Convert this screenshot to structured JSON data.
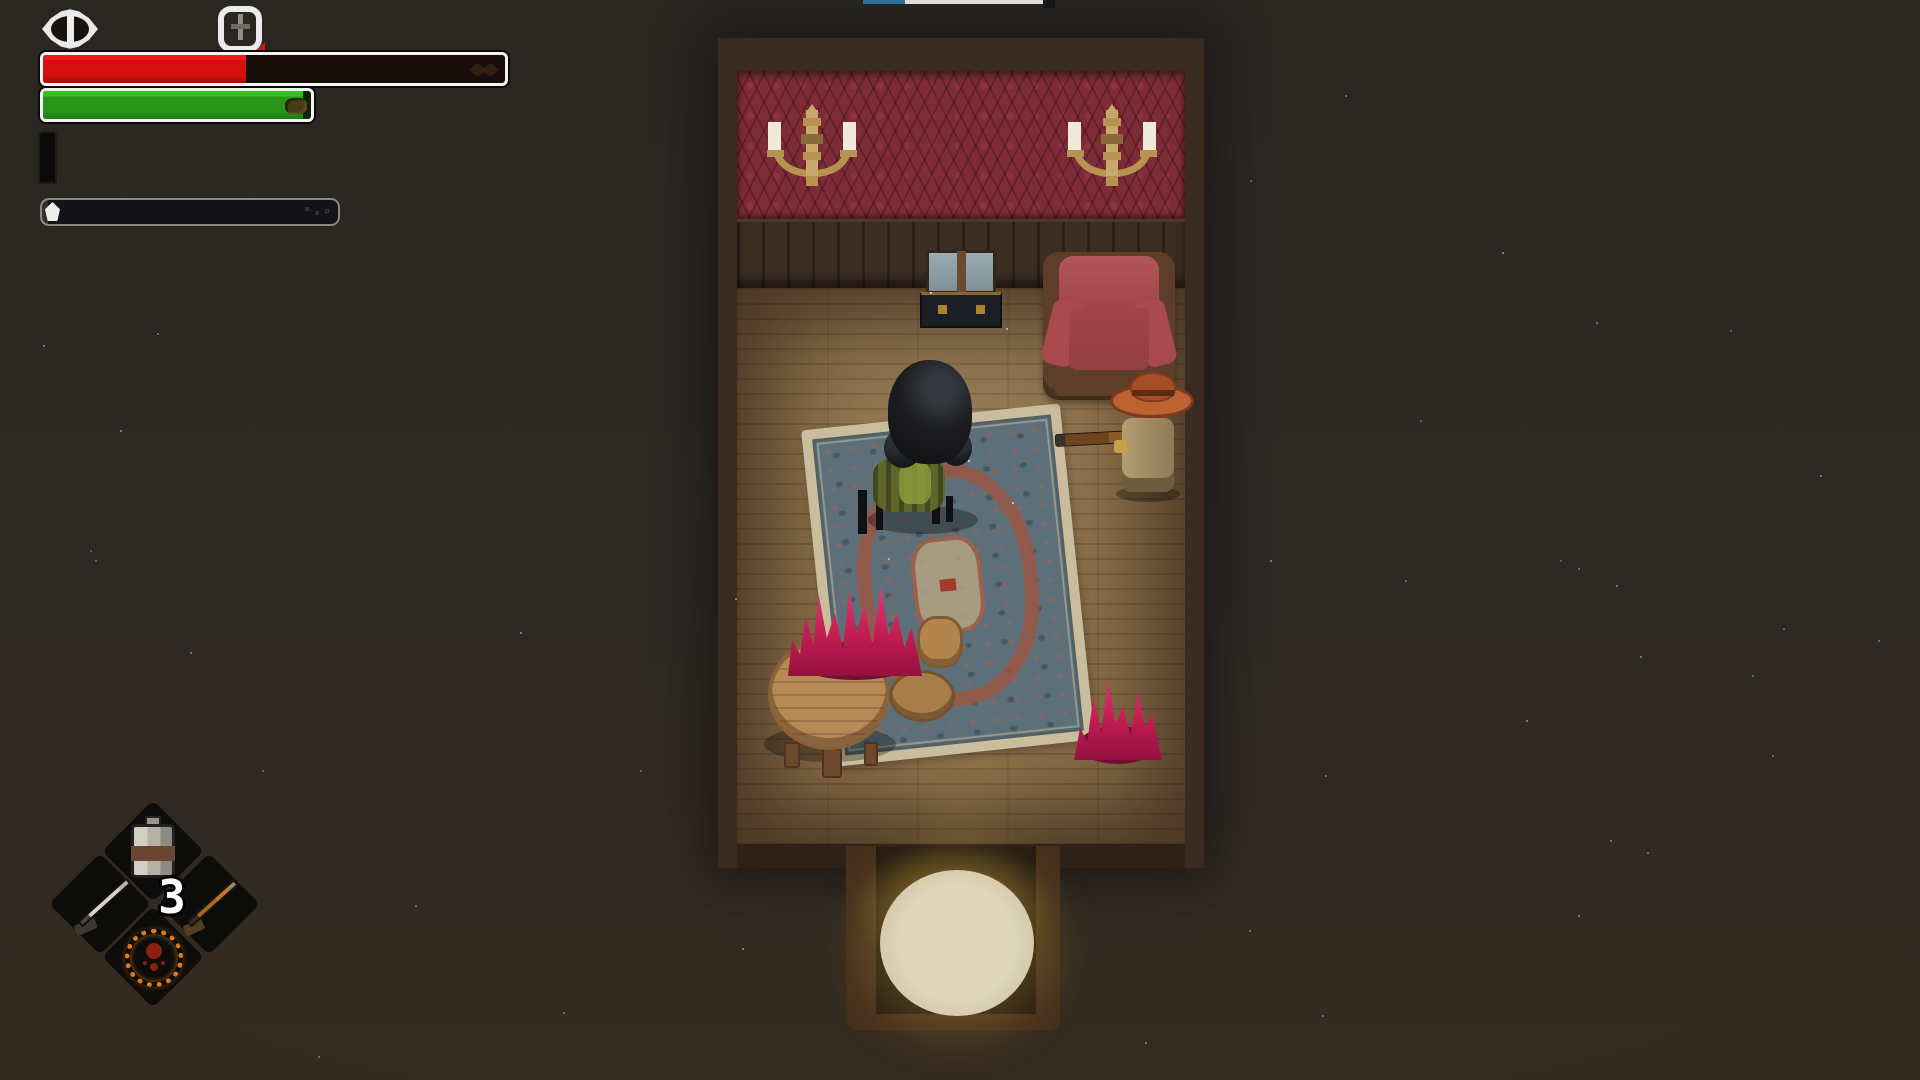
{
  "top_strip": {
    "blue_color": "#2f6f9e",
    "white_color": "#dcdcdc"
  },
  "hud": {
    "eye_icon": "eye-indicator",
    "timer_icon": "timer-indicator",
    "health_bar": {
      "fill_percent": 44,
      "fill_style": "width:44%",
      "fill_color": "#d41010",
      "border_color": "#f2f2f2"
    },
    "stamina_bar": {
      "fill_percent": 97,
      "fill_style": "width:97%",
      "fill_color": "#28961a",
      "border_color": "#f2f2f2"
    },
    "ammo": {
      "loaded": 4,
      "capacity": 6,
      "bullet_classes": [
        "bullet loaded",
        "bullet loaded",
        "bullet loaded",
        "bullet loaded",
        "bullet empty",
        "bullet empty"
      ]
    },
    "reload_bar": {
      "fill_percent": 2,
      "fill_style": "width:2%",
      "marker_color": "#f0efec"
    }
  },
  "inventory": {
    "count": "3",
    "slots": [
      {
        "name": "canteen",
        "position": "top"
      },
      {
        "name": "rifle",
        "position": "left"
      },
      {
        "name": "shotgun",
        "position": "right"
      },
      {
        "name": "fire-sigil",
        "position": "bottom"
      }
    ]
  },
  "scene": {
    "room": {
      "wallpaper_color": "#7e2d38",
      "paneling_color": "#3d2e23",
      "floor_color": "#8b6f4a",
      "frame_color": "#3a2b20"
    },
    "objects": [
      "wall-sconce-left",
      "wall-sconce-right",
      "mirror-dresser",
      "red-armchair",
      "ornate-rug",
      "round-table",
      "stool",
      "stool",
      "pink-flame-large",
      "pink-flame-small",
      "player-character",
      "cowboy-npc",
      "npc-rifle",
      "doorway-light"
    ],
    "flame_color": "#c21d52",
    "armchair_color": "#a84a4e",
    "npc_hat_color": "#bf6231",
    "doorway_glow_color": "#ded5ba"
  }
}
